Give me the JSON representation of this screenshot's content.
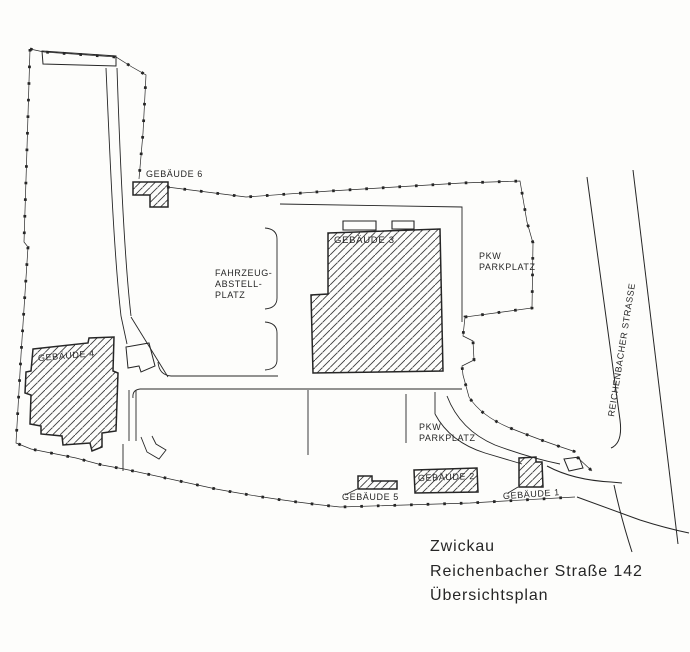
{
  "title_block": {
    "line1": "Zwickau",
    "line2": "Reichenbacher Straße 142",
    "line3": "Übersichtsplan"
  },
  "labels": {
    "building1": "GEBÄUDE 1",
    "building2": "GEBÄUDE 2",
    "building3": "GEBÄUDE 3",
    "building4": "GEBÄUDE 4",
    "building5": "GEBÄUDE 5",
    "building6": "GEBÄUDE 6",
    "vehicle_yard": {
      "line1": "FAHRZEUG-",
      "line2": "ABSTELL-",
      "line3": "PLATZ"
    },
    "parking_upper": {
      "line1": "PKW",
      "line2": "PARKPLATZ"
    },
    "parking_lower": {
      "line1": "PKW",
      "line2": "PARKPLATZ"
    },
    "street": "REICHENBACHER STRASSE"
  },
  "colors": {
    "ink": "#262626",
    "paper": "#fdfdfb",
    "hatch": "#3a3a3a"
  }
}
